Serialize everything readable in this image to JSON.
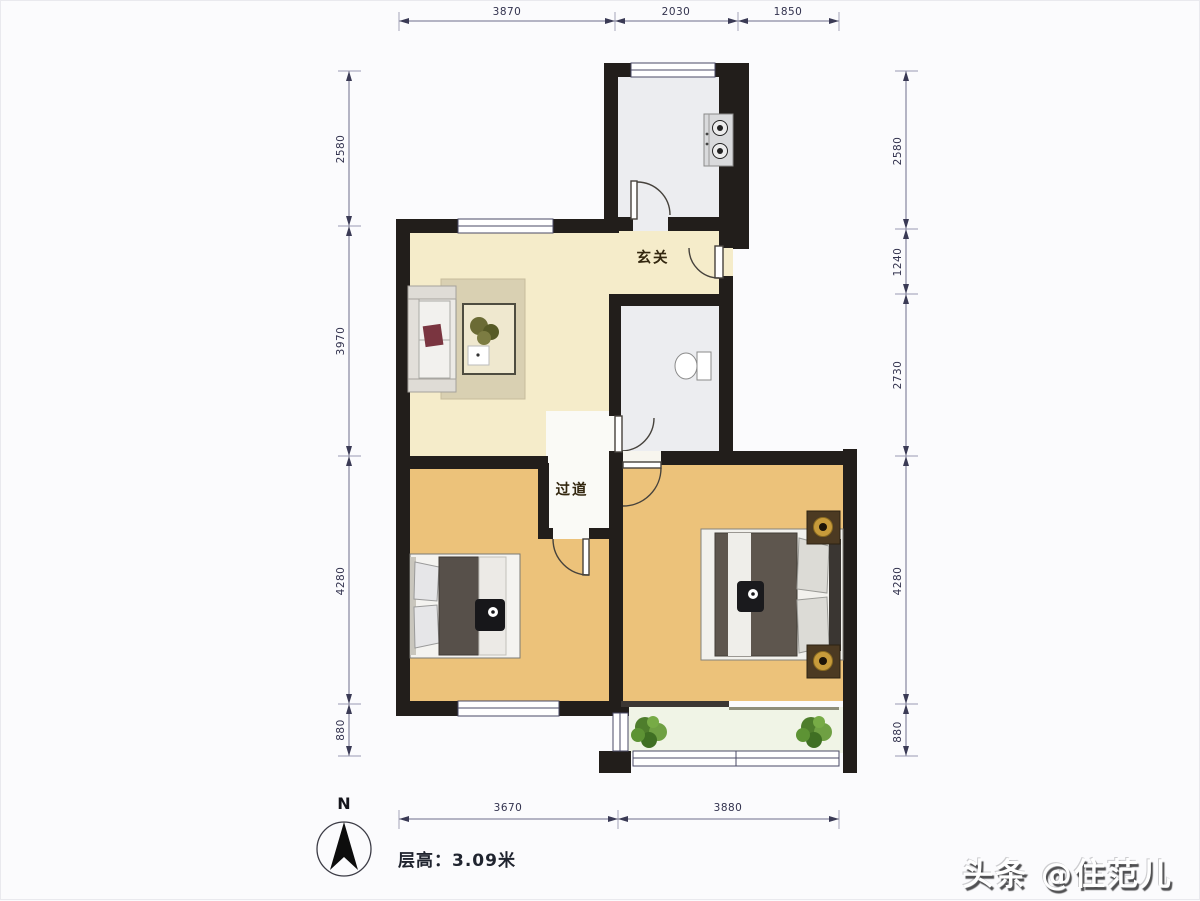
{
  "page": {
    "watermark": "头条 @住范儿"
  },
  "plan": {
    "type": "apartment-floor-plan",
    "labels": {
      "entrance": "玄关",
      "corridor": "过道"
    },
    "floor_height": "层高：3.09米",
    "compass": {
      "north_label": "N"
    },
    "dimensions": {
      "top": [
        "3870",
        "2030",
        "1850"
      ],
      "bottom": [
        "3670",
        "3880"
      ],
      "left": [
        "2580",
        "3970",
        "4280",
        "880"
      ],
      "right": [
        "2580",
        "1240",
        "2730",
        "4280",
        "880"
      ]
    },
    "colors": {
      "wall": "#221e1b",
      "living_floor": "#f5ecca",
      "bedroom_floor": "#ecc27a",
      "wet_floor": "#ecedf0",
      "balcony_floor": "#f0f4e6",
      "dimension_ink": "#32324e"
    }
  }
}
